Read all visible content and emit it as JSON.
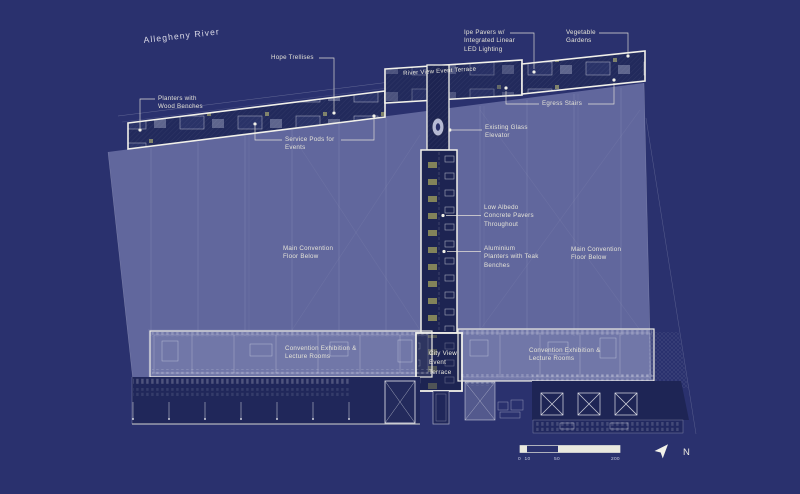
{
  "labels": {
    "allegheny_river": "Allegheny River",
    "river_view_terrace": "River View Event Terrace",
    "city_view_terrace": "City View\nEvent\nTerrace",
    "main_convention_left": "Main Convention\nFloor Below",
    "main_convention_right": "Main Convention\nFloor Below",
    "convention_left": "Convention Exhibition &\nLecture Rooms",
    "convention_right": "Convention Exhibition &\nLecture Rooms"
  },
  "callouts": {
    "planters": "Planters with\nWood Benches",
    "hope_trellises": "Hope Trellises",
    "service_pods": "Service Pods for\nEvents",
    "ipe_pavers": "Ipe Pavers w/\nIntegrated Linear\nLED Lighting",
    "vegetable_gardens": "Vegetable\nGardens",
    "egress_stairs": "Egress Stairs",
    "glass_elevator": "Existing Glass\nElevator",
    "low_albedo": "Low Albedo\nConcrete Pavers\nThroughout",
    "aluminium_planters": "Aluminium\nPlanters with Teak\nBenches"
  },
  "scale_bar": {
    "ticks": [
      "0",
      "10",
      "50",
      "200"
    ]
  },
  "north_label": "N",
  "colors": {
    "background": "#2a316e",
    "roof_overlay": "#62679d",
    "outline_white": "#f2f1ea",
    "label_text": "#e6e4d8",
    "teak_accent": "#94945c"
  }
}
